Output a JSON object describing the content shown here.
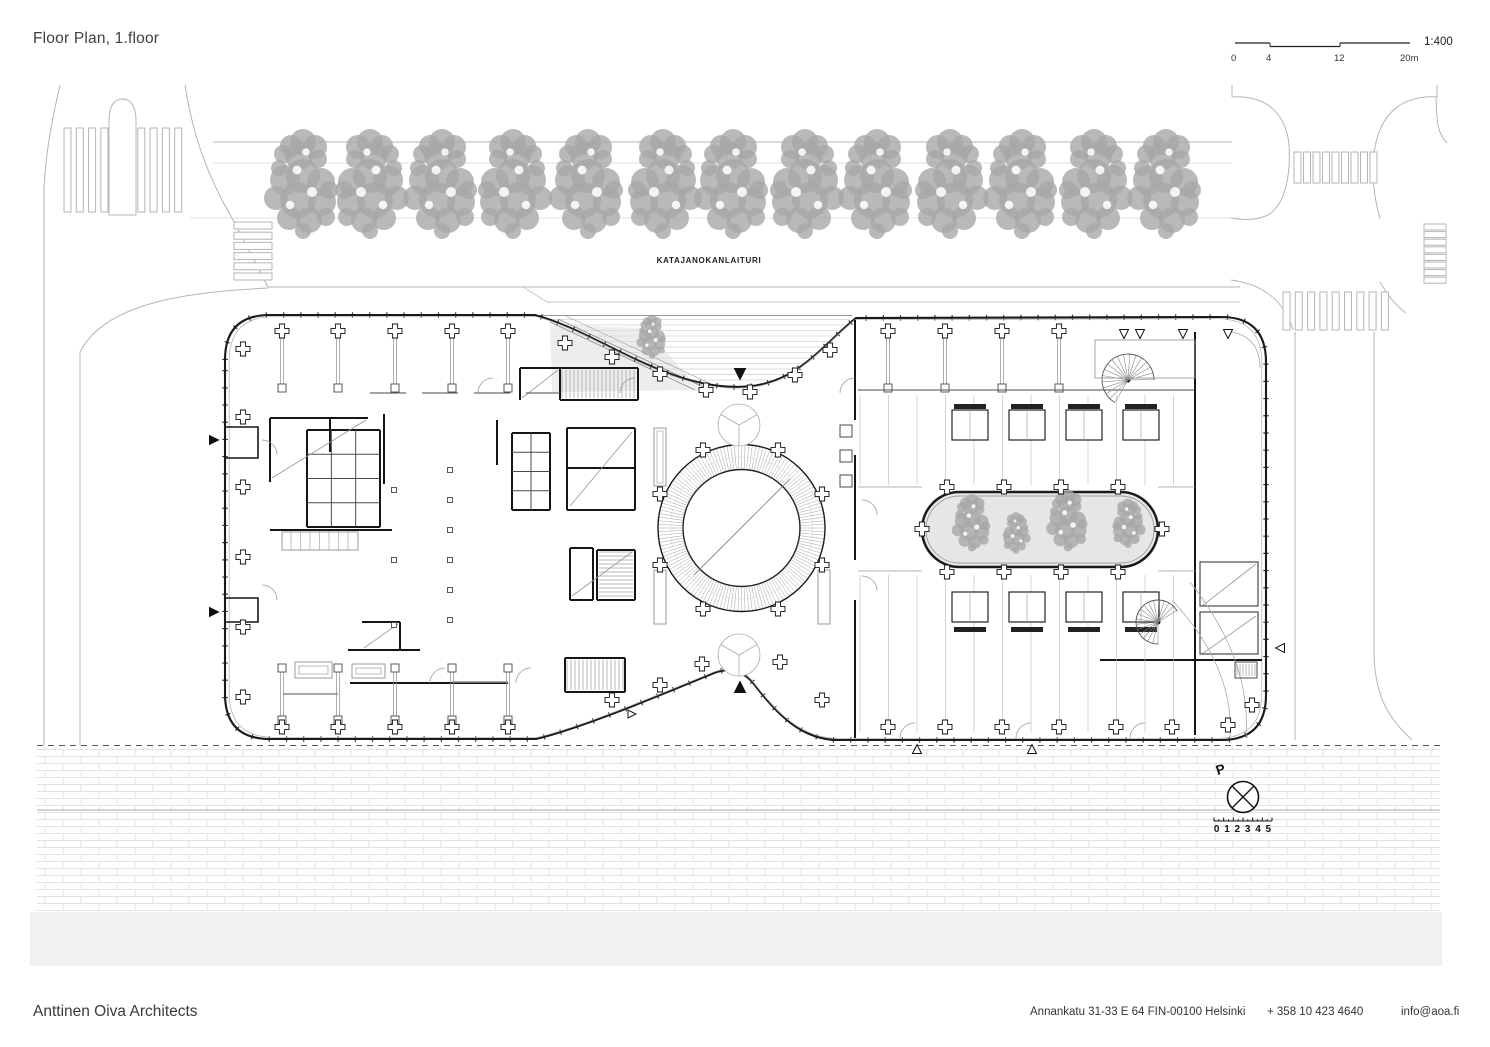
{
  "header": {
    "title": "Floor Plan, 1.floor"
  },
  "scalebar": {
    "ratio": "1:400",
    "ticks": [
      "0",
      "4",
      "12",
      "20m"
    ]
  },
  "plan": {
    "street_label": "KATAJANOKANLAITURI",
    "compass": {
      "north_label": "P",
      "ruler_numbers": "0 1 2 3 4 5"
    }
  },
  "footer": {
    "studio": "Anttinen Oiva Architects",
    "address": "Annankatu 31-33 E 64 FIN-00100 Helsinki",
    "phone": "+ 358 10 423 4640",
    "email": "info@aoa.fi"
  },
  "colors": {
    "ink": "#1a1a1a",
    "wall": "#151515",
    "medium": "#4a4a4a",
    "light": "#9a9a9a",
    "faint": "#c9c9c9",
    "street": "#b5b5b5",
    "tree": "#a7a7a7",
    "garden_fill": "#e6e6e6",
    "brick": "#e2e2e2",
    "stripe": "#cfcfcf",
    "water": "#f1f1f1"
  },
  "drawing": {
    "street_trees_x": [
      303,
      370,
      442,
      513,
      588,
      663,
      733,
      805,
      877,
      950,
      1022,
      1094,
      1166
    ],
    "street_trees_y": 192,
    "garden_trees": [
      [
        972,
        527,
        0.52
      ],
      [
        1016,
        536,
        0.38
      ],
      [
        1068,
        525,
        0.56
      ],
      [
        1128,
        527,
        0.45
      ]
    ],
    "plaza_tree": [
      652,
      340,
      0.4
    ],
    "ring": {
      "cx": 741.5,
      "cy": 528,
      "r_outer": 83.5,
      "r_inner": 58.5
    },
    "garden_rect": {
      "x": 922,
      "y": 492,
      "w": 236,
      "h": 75
    },
    "columns": [
      [
        243,
        349
      ],
      [
        282,
        331
      ],
      [
        338,
        331
      ],
      [
        395,
        331
      ],
      [
        452,
        331
      ],
      [
        508,
        331
      ],
      [
        565,
        343
      ],
      [
        612,
        357
      ],
      [
        660,
        374
      ],
      [
        706,
        390
      ],
      [
        750,
        392
      ],
      [
        795,
        375
      ],
      [
        830,
        350
      ],
      [
        888,
        331
      ],
      [
        945,
        331
      ],
      [
        1002,
        331
      ],
      [
        1059,
        331
      ],
      [
        243,
        417
      ],
      [
        243,
        487
      ],
      [
        243,
        557
      ],
      [
        243,
        627
      ],
      [
        243,
        697
      ],
      [
        282,
        727
      ],
      [
        338,
        727
      ],
      [
        395,
        727
      ],
      [
        452,
        727
      ],
      [
        508,
        727
      ],
      [
        612,
        700
      ],
      [
        660,
        685
      ],
      [
        702,
        664
      ],
      [
        780,
        662
      ],
      [
        822,
        700
      ],
      [
        888,
        727
      ],
      [
        945,
        727
      ],
      [
        1002,
        727
      ],
      [
        1059,
        727
      ],
      [
        1116,
        727
      ],
      [
        1172,
        727
      ],
      [
        1228,
        725
      ],
      [
        703,
        450
      ],
      [
        778,
        450
      ],
      [
        660,
        494
      ],
      [
        822,
        494
      ],
      [
        660,
        565
      ],
      [
        822,
        565
      ],
      [
        703,
        609
      ],
      [
        778,
        609
      ],
      [
        947,
        487
      ],
      [
        1004,
        487
      ],
      [
        1061,
        487
      ],
      [
        1118,
        487
      ],
      [
        947,
        572
      ],
      [
        1004,
        572
      ],
      [
        1061,
        572
      ],
      [
        1118,
        572
      ],
      [
        922,
        529
      ],
      [
        1162,
        529
      ],
      [
        1252,
        705
      ]
    ]
  }
}
